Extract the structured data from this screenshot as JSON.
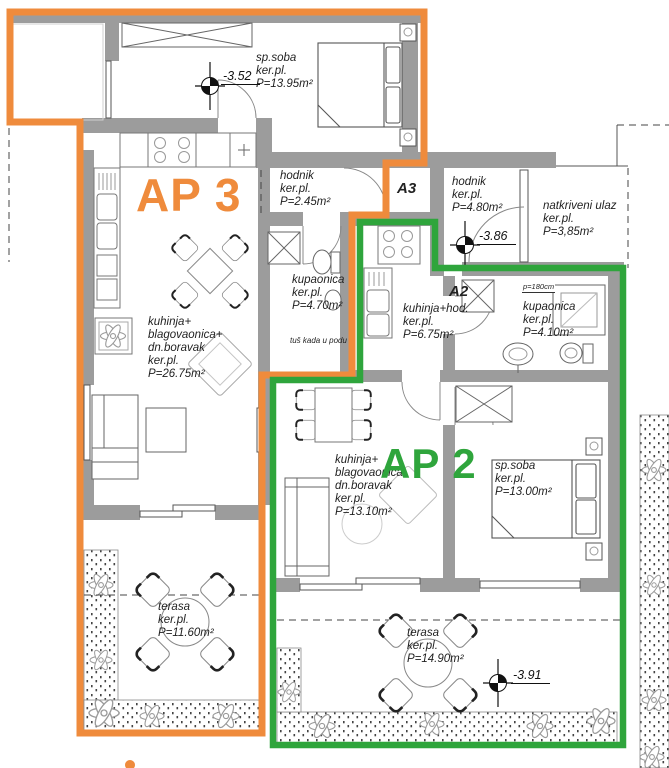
{
  "colors": {
    "ap3_orange": "#EF8B3C",
    "ap2_green": "#2FA53C",
    "wall_gray": "#9C9C9C",
    "line_dark": "#555555",
    "text_dark": "#1F1F1F"
  },
  "apartments": {
    "ap3": {
      "label": "AP 3"
    },
    "ap2": {
      "label": "AP 2"
    }
  },
  "unit_markers": {
    "a3": "A3",
    "a2": "A2"
  },
  "rooms": {
    "sp_soba_ap3": {
      "lines": [
        "sp.soba",
        "ker.pl.",
        "P=13.95m²"
      ]
    },
    "hodnik_ap3": {
      "lines": [
        "hodnik",
        "ker.pl.",
        "P=2.45m²"
      ]
    },
    "kupaonica_ap3": {
      "lines": [
        "kupaonica",
        "ker.pl.",
        "P=4.70m²"
      ]
    },
    "kuhinja_ap3": {
      "lines": [
        "kuhinja+",
        "blagovaonica+",
        "dn.boravak",
        "ker.pl.",
        "P=26.75m²"
      ]
    },
    "terasa_ap3": {
      "lines": [
        "terasa",
        "ker.pl.",
        "P=11.60m²"
      ]
    },
    "hodnik_a2": {
      "lines": [
        "hodnik",
        "ker.pl.",
        "P=4.80m²"
      ]
    },
    "natkriveni_ulaz": {
      "lines": [
        "natkriveni ulaz",
        "ker.pl.",
        "P=3,85m²"
      ]
    },
    "kuhinja_hod_a2": {
      "lines": [
        "kuhinja+hod.",
        "ker.pl.",
        "P=6.75m²"
      ]
    },
    "kupaonica_a2": {
      "lines": [
        "kupaonica",
        "ker.pl.",
        "P=4.10m²"
      ]
    },
    "kuhinja_ap2": {
      "lines": [
        "kuhinja+",
        "blagovaonica",
        "dn.boravak",
        "ker.pl.",
        "P=13.10m²"
      ]
    },
    "sp_soba_ap2": {
      "lines": [
        "sp.soba",
        "ker.pl.",
        "P=13.00m²"
      ]
    },
    "terasa_ap2": {
      "lines": [
        "terasa",
        "ker.pl.",
        "P=14.90m²"
      ]
    }
  },
  "annotations": {
    "tus_kada": "tuš kada  u podu",
    "p180": "p=180cm"
  },
  "elevations": {
    "bedroom_ap3": "-3.52",
    "entry": "-3.86",
    "terrace_ap2": "-3.91"
  }
}
